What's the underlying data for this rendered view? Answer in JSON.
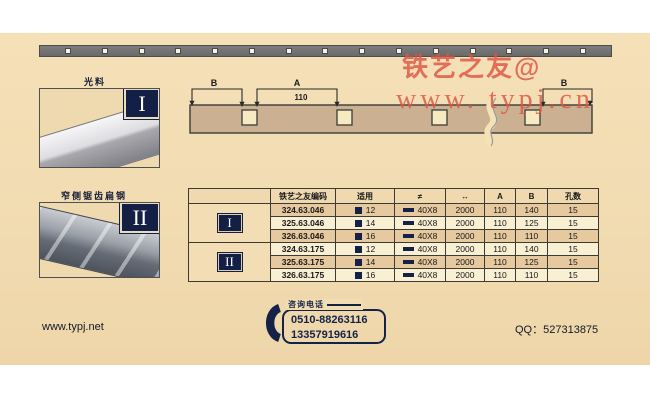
{
  "watermark": {
    "line1": "铁艺之友@",
    "line2": "www. typj.cn"
  },
  "photos": [
    {
      "label": "光料",
      "numeral": "I"
    },
    {
      "label": "窄侧锯齿扁钢",
      "numeral": "II"
    }
  ],
  "diagram": {
    "label_b_left": "B",
    "label_a": "A",
    "value_a": "110",
    "label_b_right": "B"
  },
  "table": {
    "headers": {
      "code": "铁艺之友编码",
      "fit": "适用",
      "section": "≠",
      "length": "↔",
      "a": "A",
      "b": "B",
      "holes": "孔数"
    },
    "groups": [
      {
        "numeral": "I",
        "rows": [
          {
            "code": "324.63.046",
            "fit": "12",
            "section": "40X8",
            "length": "2000",
            "a": "110",
            "b": "140",
            "holes": "15"
          },
          {
            "code": "325.63.046",
            "fit": "14",
            "section": "40X8",
            "length": "2000",
            "a": "110",
            "b": "125",
            "holes": "15"
          },
          {
            "code": "326.63.046",
            "fit": "16",
            "section": "40X8",
            "length": "2000",
            "a": "110",
            "b": "110",
            "holes": "15"
          }
        ]
      },
      {
        "numeral": "II",
        "rows": [
          {
            "code": "324.63.175",
            "fit": "12",
            "section": "40X8",
            "length": "2000",
            "a": "110",
            "b": "140",
            "holes": "15"
          },
          {
            "code": "325.63.175",
            "fit": "14",
            "section": "40X8",
            "length": "2000",
            "a": "110",
            "b": "125",
            "holes": "15"
          },
          {
            "code": "326.63.175",
            "fit": "16",
            "section": "40X8",
            "length": "2000",
            "a": "110",
            "b": "110",
            "holes": "15"
          }
        ]
      }
    ]
  },
  "footer": {
    "website": "www.typj.net",
    "phone_label": "咨询电话",
    "phone1": "0510-88263116",
    "phone2": "13357919616",
    "qq": "QQ：527313875"
  },
  "colors": {
    "navy": "#152248",
    "watermark_red": "#dd5642",
    "card_tan": "#f2dcb2"
  }
}
